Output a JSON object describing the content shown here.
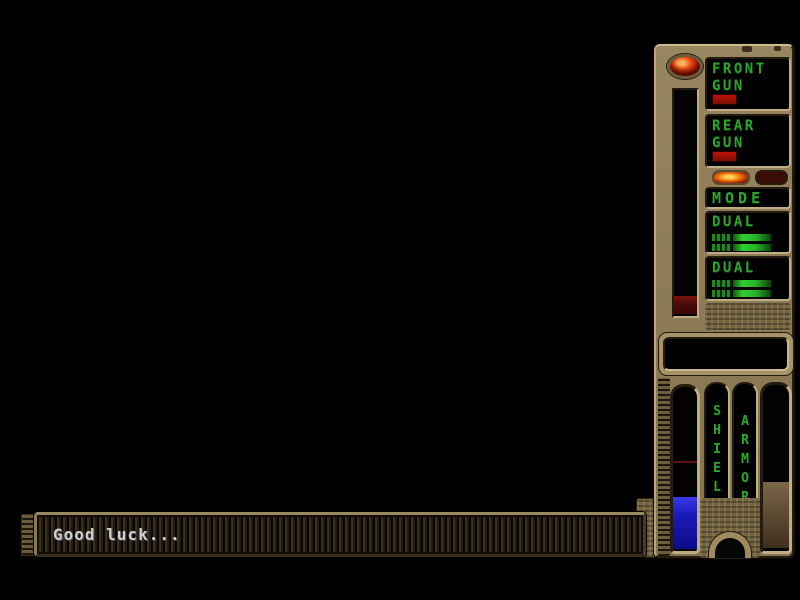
{
  "hud": {
    "front_gun": {
      "line1": "FRONT",
      "line2": "GUN"
    },
    "rear_gun": {
      "line1": "REAR",
      "line2": "GUN"
    },
    "mode_label": "MODE",
    "dual_top": {
      "label": "DUAL",
      "bar_rows": 2
    },
    "dual_bottom": {
      "label": "DUAL",
      "bar_rows": 2
    },
    "shield_label": "SHIELD",
    "armor_label": "ARMOR",
    "shield_fill_percent": 32,
    "armor_fill_percent": 40,
    "power_fill_percent": 8
  },
  "message_bar": {
    "text": "Good luck..."
  },
  "icons": {
    "power_led": "red oval lamp, lit",
    "mode_indicator_lit": "orange rounded lamp, on",
    "mode_indicator_unlit": "dark rounded lamp, off"
  },
  "colors": {
    "panel_tan": "#8e7d58",
    "panel_highlight": "#cbba90",
    "panel_shadow": "#241c10",
    "screen_green": "#2ba52b",
    "bar_green": "#2fd02f",
    "ammo_red": "#a81408",
    "shield_blue": "#2222cc",
    "armor_brown": "#6f5a40",
    "message_text": "#cfcfcf"
  }
}
